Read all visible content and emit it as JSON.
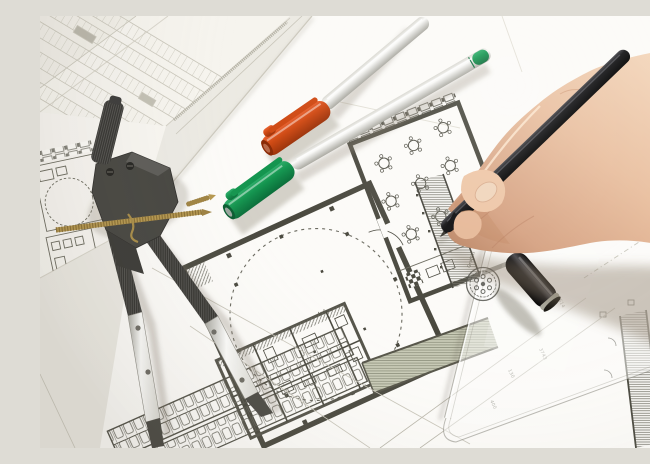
{
  "meta": {
    "type": "photograph",
    "subject": "Hand of an architect drawing with a black pen on architectural floor plans, surrounded by a drafting compass, capped marker pens, a transparent set square and a black pen cap"
  },
  "colors": {
    "paper_base": "#eceae3",
    "paper_mid": "#f6f4ee",
    "paper_bright": "#fcfbf8",
    "ink": "#4a493f",
    "ink_soft": "#6b6a5e",
    "line_faint": "#c9c6ba",
    "micro_text": "#b0ada0",
    "skin_hi": "#f6dcc2",
    "skin_mid": "#e9bf9f",
    "skin_lo": "#d5a181",
    "skin_shadow": "#b98362",
    "nail": "#f0d5bb",
    "orange_hi": "#e86230",
    "orange_mid": "#d04a14",
    "orange_lo": "#9c330a",
    "green_hi": "#2fae6b",
    "green_mid": "#14954f",
    "green_lo": "#0b6e3a",
    "silver_hi": "#fbfbf9",
    "silver_mid": "#d9d8d1",
    "silver_lo": "#a9a8a0",
    "brass": "#b5974e",
    "brass_dark": "#8a6f33",
    "tool_black": "#33322e",
    "tool_dark": "#23221f",
    "pen_black": "#141416",
    "pen_hi": "#45454a",
    "metal_tip": "#4c4a44",
    "band_green": "#c8cab6",
    "band_line": "#8f927e",
    "cap_ring": "#a8a89c",
    "stamp_ink": "#50504a"
  },
  "objects": [
    {
      "name": "drafting-compass",
      "label": "drafting compass divider"
    },
    {
      "name": "orange-marker-pen",
      "label": "orange-capped marker pen"
    },
    {
      "name": "green-marker-pen",
      "label": "green-capped marker pen"
    },
    {
      "name": "black-drawing-pen",
      "label": "black drawing pen"
    },
    {
      "name": "right-hand",
      "label": "right hand holding pen"
    },
    {
      "name": "black-pen-cap",
      "label": "black pen cap"
    },
    {
      "name": "set-square",
      "label": "transparent set square ruler"
    },
    {
      "name": "floor-plans",
      "label": "layered architectural floor plan sheets"
    }
  ],
  "annotations": {
    "room_dimension": "4x0",
    "dim_right_upper": "2614",
    "dim_right_mid": "3743",
    "dim_right_low": "130",
    "dim_bottom": "400"
  },
  "ruler": {
    "brand_text": "Graffiti"
  }
}
